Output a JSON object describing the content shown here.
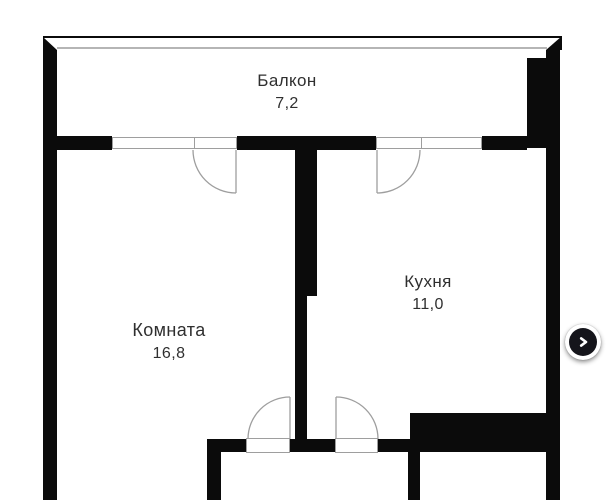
{
  "floorplan": {
    "rooms": [
      {
        "id": "balcony",
        "name": "Балкон",
        "area": "7,2"
      },
      {
        "id": "room",
        "name": "Комната",
        "area": "16,8"
      },
      {
        "id": "kitchen",
        "name": "Кухня",
        "area": "11,0"
      }
    ]
  },
  "carousel": {
    "next_button": {
      "icon": "chevron-right"
    }
  },
  "colors": {
    "background": "#ffffff",
    "wall": "#0b0b0b",
    "label_text": "#2f2f2f",
    "thin_line": "#9e9e9e",
    "balcony_inner_line": "#b5b5b5",
    "button_fill": "#15151b",
    "button_ring": "#ffffff",
    "button_icon": "#ffffff"
  }
}
